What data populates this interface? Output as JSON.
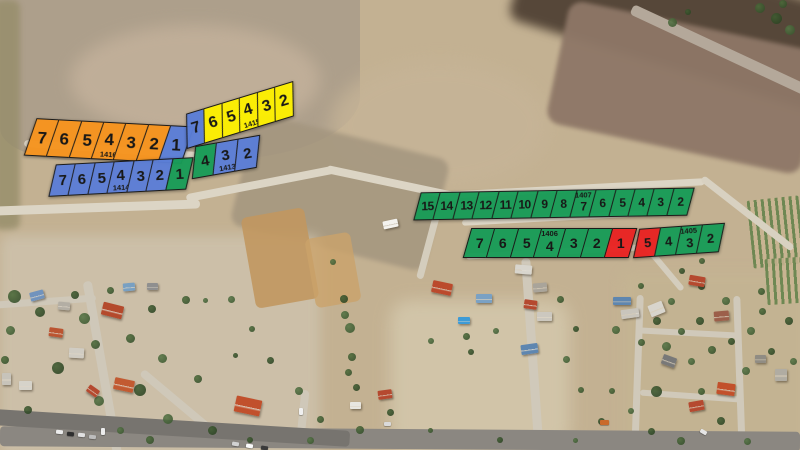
{
  "colors": {
    "orange": "#f7941e",
    "blue": "#5b7ed7",
    "yellow": "#fdf000",
    "green": "#189c57",
    "red": "#e92322"
  },
  "blocks": [
    {
      "id": "1416",
      "label_cell": 3,
      "label_side": "bottom",
      "geometry": {
        "x": 30,
        "y": 122,
        "w": 158,
        "h": 38,
        "rot": 3,
        "font": 17
      },
      "parcels": [
        {
          "num": "7",
          "color": "orange"
        },
        {
          "num": "6",
          "color": "orange"
        },
        {
          "num": "5",
          "color": "orange"
        },
        {
          "num": "4",
          "color": "orange"
        },
        {
          "num": "3",
          "color": "orange"
        },
        {
          "num": "2",
          "color": "orange"
        },
        {
          "num": "1",
          "color": "blue"
        }
      ]
    },
    {
      "id": "1415",
      "label_cell": 3,
      "label_side": "bottom",
      "geometry": {
        "x": 184,
        "y": 98,
        "w": 112,
        "h": 34,
        "rot": -17,
        "font": 16
      },
      "parcels": [
        {
          "num": "7",
          "color": "blue"
        },
        {
          "num": "6",
          "color": "yellow"
        },
        {
          "num": "5",
          "color": "yellow"
        },
        {
          "num": "4",
          "color": "yellow"
        },
        {
          "num": "3",
          "color": "yellow"
        },
        {
          "num": "2",
          "color": "yellow"
        }
      ]
    },
    {
      "id": "1414",
      "label_cell": 3,
      "label_side": "bottom",
      "geometry": {
        "x": 52,
        "y": 161,
        "w": 138,
        "h": 32,
        "rot": -3,
        "font": 15
      },
      "parcels": [
        {
          "num": "7",
          "color": "blue"
        },
        {
          "num": "6",
          "color": "blue"
        },
        {
          "num": "5",
          "color": "blue"
        },
        {
          "num": "4",
          "color": "blue"
        },
        {
          "num": "3",
          "color": "blue"
        },
        {
          "num": "2",
          "color": "blue"
        },
        {
          "num": "1",
          "color": "green"
        }
      ]
    },
    {
      "id": "1413",
      "label_cell": 1,
      "label_side": "bottom",
      "geometry": {
        "x": 193,
        "y": 141,
        "w": 66,
        "h": 32,
        "rot": -10,
        "font": 15
      },
      "parcels": [
        {
          "num": "4",
          "color": "green"
        },
        {
          "num": "3",
          "color": "blue"
        },
        {
          "num": "2",
          "color": "blue"
        }
      ]
    },
    {
      "id": "1407",
      "label_cell": 8,
      "label_side": "top",
      "geometry": {
        "x": 417,
        "y": 190,
        "w": 274,
        "h": 28,
        "rot": -1,
        "font": 12
      },
      "parcels": [
        {
          "num": "15",
          "color": "green"
        },
        {
          "num": "14",
          "color": "green"
        },
        {
          "num": "13",
          "color": "green"
        },
        {
          "num": "12",
          "color": "green"
        },
        {
          "num": "11",
          "color": "green"
        },
        {
          "num": "10",
          "color": "green"
        },
        {
          "num": "9",
          "color": "green"
        },
        {
          "num": "8",
          "color": "green"
        },
        {
          "num": "7",
          "color": "green"
        },
        {
          "num": "6",
          "color": "green"
        },
        {
          "num": "5",
          "color": "green"
        },
        {
          "num": "4",
          "color": "green"
        },
        {
          "num": "3",
          "color": "green"
        },
        {
          "num": "2",
          "color": "green"
        }
      ]
    },
    {
      "id": "1406",
      "label_cell": 3,
      "label_side": "top",
      "geometry": {
        "x": 467,
        "y": 228,
        "w": 166,
        "h": 30,
        "rot": 0,
        "font": 14
      },
      "parcels": [
        {
          "num": "7",
          "color": "green"
        },
        {
          "num": "6",
          "color": "green"
        },
        {
          "num": "5",
          "color": "green"
        },
        {
          "num": "4",
          "color": "green"
        },
        {
          "num": "3",
          "color": "green"
        },
        {
          "num": "2",
          "color": "green"
        },
        {
          "num": "1",
          "color": "red"
        }
      ]
    },
    {
      "id": "1405",
      "label_cell": 2,
      "label_side": "top",
      "geometry": {
        "x": 636,
        "y": 226,
        "w": 86,
        "h": 29,
        "rot": -4,
        "font": 13
      },
      "parcels": [
        {
          "num": "5",
          "color": "red"
        },
        {
          "num": "4",
          "color": "green"
        },
        {
          "num": "3",
          "color": "green"
        },
        {
          "num": "2",
          "color": "green"
        }
      ]
    }
  ]
}
